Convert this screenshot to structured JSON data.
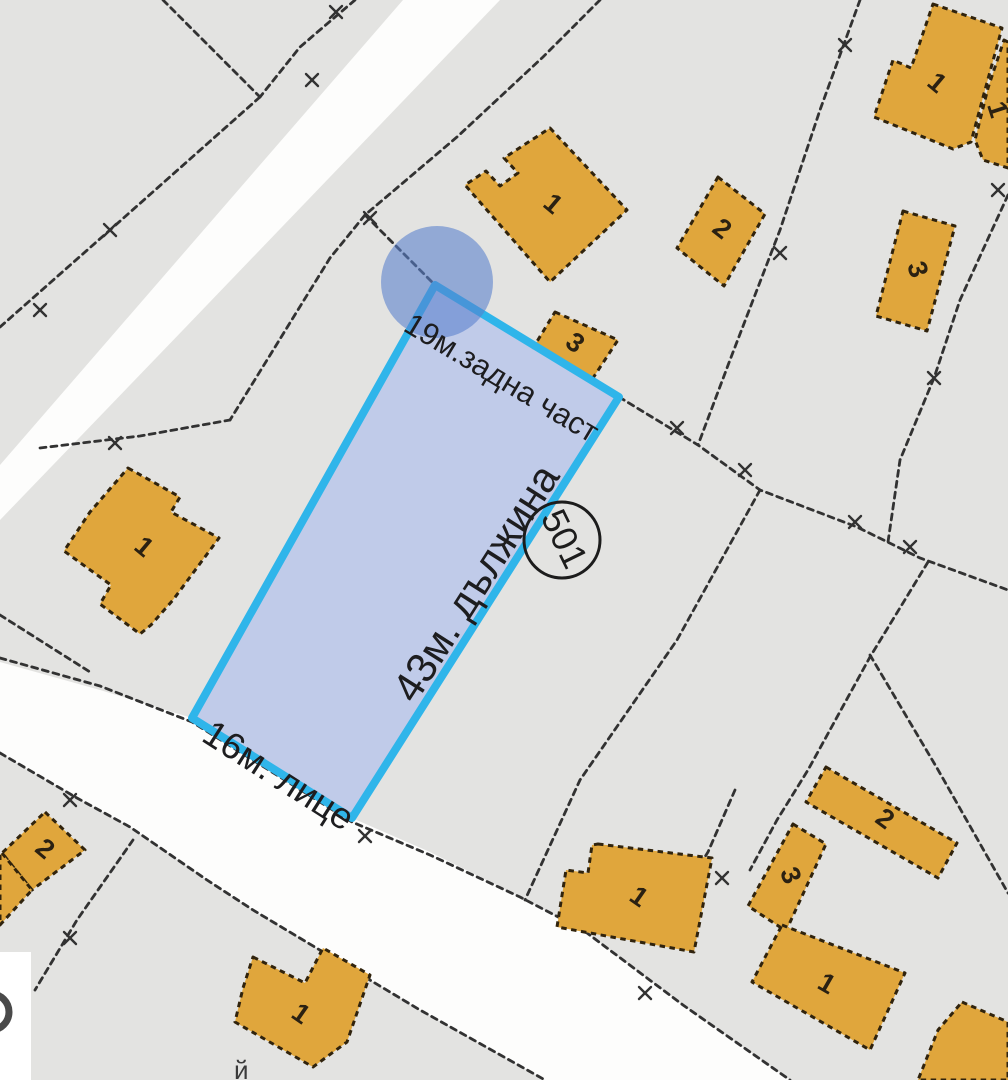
{
  "map": {
    "background_color": "#e3e3e1",
    "road_color": "#fdfdfc",
    "boundary_color": "#323232",
    "building_style": {
      "fill": "#e0a63c",
      "stroke": "#30230d"
    },
    "roads": [
      [
        [
          403,
          0
        ],
        [
          500,
          0
        ],
        [
          183,
          330
        ],
        [
          0,
          520
        ],
        [
          0,
          465
        ],
        [
          117,
          330
        ]
      ],
      [
        [
          0,
          662
        ],
        [
          100,
          690
        ],
        [
          192,
          718
        ],
        [
          352,
          818
        ],
        [
          430,
          852
        ],
        [
          520,
          897
        ],
        [
          583,
          930
        ],
        [
          683,
          1005
        ],
        [
          790,
          1080
        ],
        [
          545,
          1080
        ],
        [
          420,
          1010
        ],
        [
          253,
          910
        ],
        [
          207,
          880
        ],
        [
          130,
          827
        ],
        [
          77,
          798
        ],
        [
          0,
          753
        ]
      ]
    ],
    "boundaries": [
      [
        [
          163,
          0
        ],
        [
          260,
          97
        ]
      ],
      [
        [
          355,
          0
        ],
        [
          300,
          47
        ],
        [
          260,
          97
        ]
      ],
      [
        [
          260,
          97
        ],
        [
          110,
          230
        ],
        [
          0,
          327
        ]
      ],
      [
        [
          600,
          0
        ],
        [
          543,
          57
        ],
        [
          457,
          137
        ],
        [
          365,
          215
        ]
      ],
      [
        [
          365,
          215
        ],
        [
          435,
          285
        ]
      ],
      [
        [
          365,
          215
        ],
        [
          330,
          258
        ],
        [
          230,
          420
        ]
      ],
      [
        [
          40,
          448
        ],
        [
          140,
          436
        ],
        [
          230,
          420
        ]
      ],
      [
        [
          0,
          615
        ],
        [
          90,
          672
        ]
      ],
      [
        [
          0,
          658
        ],
        [
          100,
          686
        ],
        [
          192,
          722
        ],
        [
          352,
          822
        ],
        [
          430,
          855
        ],
        [
          520,
          897
        ],
        [
          583,
          930
        ],
        [
          683,
          1005
        ],
        [
          790,
          1080
        ]
      ],
      [
        [
          0,
          753
        ],
        [
          77,
          798
        ],
        [
          130,
          827
        ],
        [
          207,
          880
        ],
        [
          253,
          910
        ],
        [
          420,
          1010
        ],
        [
          545,
          1080
        ]
      ],
      [
        [
          133,
          840
        ],
        [
          77,
          920
        ],
        [
          35,
          990
        ]
      ],
      [
        [
          860,
          0
        ],
        [
          820,
          110
        ],
        [
          780,
          230
        ],
        [
          730,
          360
        ],
        [
          698,
          445
        ]
      ],
      [
        [
          619,
          397
        ],
        [
          698,
          445
        ],
        [
          760,
          490
        ],
        [
          857,
          527
        ],
        [
          920,
          558
        ],
        [
          1008,
          590
        ]
      ],
      [
        [
          760,
          490
        ],
        [
          677,
          640
        ],
        [
          580,
          780
        ],
        [
          525,
          900
        ]
      ],
      [
        [
          1008,
          195
        ],
        [
          960,
          300
        ],
        [
          934,
          378
        ],
        [
          900,
          460
        ],
        [
          888,
          542
        ]
      ],
      [
        [
          928,
          562
        ],
        [
          870,
          657
        ],
        [
          808,
          770
        ],
        [
          777,
          820
        ],
        [
          750,
          870
        ]
      ],
      [
        [
          870,
          655
        ],
        [
          937,
          768
        ],
        [
          1008,
          893
        ]
      ],
      [
        [
          735,
          790
        ],
        [
          708,
          852
        ],
        [
          687,
          885
        ],
        [
          668,
          925
        ]
      ]
    ],
    "markers": [
      [
        336,
        12
      ],
      [
        312,
        80
      ],
      [
        110,
        230
      ],
      [
        40,
        310
      ],
      [
        370,
        218
      ],
      [
        845,
        45
      ],
      [
        998,
        190
      ],
      [
        780,
        253
      ],
      [
        934,
        378
      ],
      [
        677,
        428
      ],
      [
        745,
        470
      ],
      [
        855,
        522
      ],
      [
        910,
        547
      ],
      [
        115,
        443
      ],
      [
        70,
        800
      ],
      [
        70,
        938
      ],
      [
        365,
        836
      ],
      [
        645,
        993
      ],
      [
        722,
        878
      ]
    ],
    "buildings": [
      {
        "number": "1",
        "points": [
          [
            550,
            128
          ],
          [
            627,
            210
          ],
          [
            550,
            282
          ],
          [
            465,
            185
          ],
          [
            486,
            171
          ],
          [
            500,
            186
          ],
          [
            518,
            173
          ],
          [
            504,
            158
          ]
        ],
        "nx": 552,
        "ny": 205,
        "nr": 40
      },
      {
        "number": "2",
        "points": [
          [
            718,
            177
          ],
          [
            765,
            214
          ],
          [
            724,
            286
          ],
          [
            677,
            248
          ]
        ],
        "nx": 721,
        "ny": 230,
        "nr": 38
      },
      {
        "number": "3",
        "points": [
          [
            555,
            312
          ],
          [
            618,
            340
          ],
          [
            593,
            378
          ],
          [
            533,
            348
          ]
        ],
        "nx": 574,
        "ny": 344,
        "nr": 38
      },
      {
        "number": "1",
        "points": [
          [
            933,
            4
          ],
          [
            1002,
            28
          ],
          [
            985,
            90
          ],
          [
            971,
            142
          ],
          [
            953,
            149
          ],
          [
            874,
            117
          ],
          [
            893,
            60
          ],
          [
            911,
            68
          ],
          [
            919,
            45
          ]
        ],
        "nx": 936,
        "ny": 84,
        "nr": 40
      },
      {
        "number": "1",
        "points": [
          [
            1004,
            40
          ],
          [
            1008,
            42
          ],
          [
            1008,
            168
          ],
          [
            983,
            160
          ],
          [
            975,
            140
          ],
          [
            988,
            88
          ]
        ],
        "nx": 996,
        "ny": 110,
        "nr": 72
      },
      {
        "number": "3",
        "points": [
          [
            903,
            211
          ],
          [
            955,
            226
          ],
          [
            927,
            331
          ],
          [
            876,
            316
          ]
        ],
        "nx": 916,
        "ny": 270,
        "nr": 72
      },
      {
        "number": "1",
        "points": [
          [
            128,
            468
          ],
          [
            180,
            497
          ],
          [
            171,
            512
          ],
          [
            219,
            538
          ],
          [
            173,
            600
          ],
          [
            151,
            625
          ],
          [
            140,
            634
          ],
          [
            100,
            604
          ],
          [
            111,
            585
          ],
          [
            64,
            551
          ],
          [
            90,
            512
          ]
        ],
        "nx": 143,
        "ny": 548,
        "nr": 40
      },
      {
        "number": "1",
        "points": [
          [
            253,
            957
          ],
          [
            305,
            983
          ],
          [
            323,
            948
          ],
          [
            370,
            975
          ],
          [
            347,
            1042
          ],
          [
            313,
            1067
          ],
          [
            235,
            1022
          ],
          [
            243,
            988
          ]
        ],
        "nx": 300,
        "ny": 1015,
        "nr": 35
      },
      {
        "number": "1",
        "points": [
          [
            598,
            844
          ],
          [
            712,
            858
          ],
          [
            694,
            952
          ],
          [
            557,
            927
          ],
          [
            566,
            870
          ],
          [
            588,
            873
          ],
          [
            592,
            845
          ]
        ],
        "nx": 638,
        "ny": 898,
        "nr": 35
      },
      {
        "number": "2",
        "points": [
          [
            826,
            767
          ],
          [
            957,
            843
          ],
          [
            938,
            878
          ],
          [
            806,
            802
          ]
        ],
        "nx": 884,
        "ny": 820,
        "nr": 36
      },
      {
        "number": "3",
        "points": [
          [
            793,
            824
          ],
          [
            826,
            844
          ],
          [
            786,
            931
          ],
          [
            748,
            906
          ]
        ],
        "nx": 789,
        "ny": 876,
        "nr": 68
      },
      {
        "number": "1",
        "points": [
          [
            782,
            925
          ],
          [
            905,
            973
          ],
          [
            870,
            1050
          ],
          [
            752,
            982
          ]
        ],
        "nx": 826,
        "ny": 985,
        "nr": 30
      },
      {
        "number": "",
        "points": [
          [
            962,
            1002
          ],
          [
            1008,
            1022
          ],
          [
            1008,
            1080
          ],
          [
            918,
            1080
          ],
          [
            938,
            1030
          ]
        ],
        "nx": 0,
        "ny": 0,
        "nr": 0
      },
      {
        "number": "2",
        "points": [
          [
            45,
            812
          ],
          [
            85,
            850
          ],
          [
            32,
            890
          ],
          [
            2,
            853
          ]
        ],
        "nx": 44,
        "ny": 850,
        "nr": 40
      },
      {
        "number": "",
        "points": [
          [
            2,
            853
          ],
          [
            32,
            890
          ],
          [
            0,
            925
          ],
          [
            0,
            855
          ]
        ],
        "nx": 0,
        "ny": 0,
        "nr": 0
      }
    ],
    "number_color": "#2b2112",
    "parcel": {
      "points": [
        [
          435,
          285
        ],
        [
          619,
          397
        ],
        [
          352,
          818
        ],
        [
          192,
          718
        ]
      ],
      "fill": "#bdc9e9",
      "stroke": "#2fb5ea",
      "stroke_width": 8,
      "labels": [
        {
          "text": "19м.задна част",
          "x": 402,
          "y": 330,
          "rotate": 31,
          "size": 31
        },
        {
          "text": "43м. дължина",
          "x": 415,
          "y": 705,
          "rotate": -57.5,
          "size": 42
        },
        {
          "text": "16м. лице",
          "x": 200,
          "y": 740,
          "rotate": 32.5,
          "size": 37
        }
      ],
      "label_color": "#1d1d1f",
      "badge": {
        "text": "501",
        "cx": 562,
        "cy": 540,
        "r": 38,
        "rotate": 64,
        "size": 36,
        "stroke": "#1c1c1c"
      },
      "corner_marker": {
        "cx": 437,
        "cy": 282,
        "r": 56,
        "fill": "rgba(88,128,205,0.58)"
      }
    },
    "corner_overlay": {
      "x": 0,
      "y": 952,
      "width": 31,
      "height": 128,
      "fill": "#ffffff",
      "glyph": {
        "cx": -9,
        "cy": 1012,
        "r": 18,
        "stroke": "#4a4a4a",
        "width": 7
      }
    },
    "edge_text": {
      "text": "й",
      "x": 234,
      "y": 1079,
      "size": 26,
      "color": "#3a3a3a"
    }
  }
}
